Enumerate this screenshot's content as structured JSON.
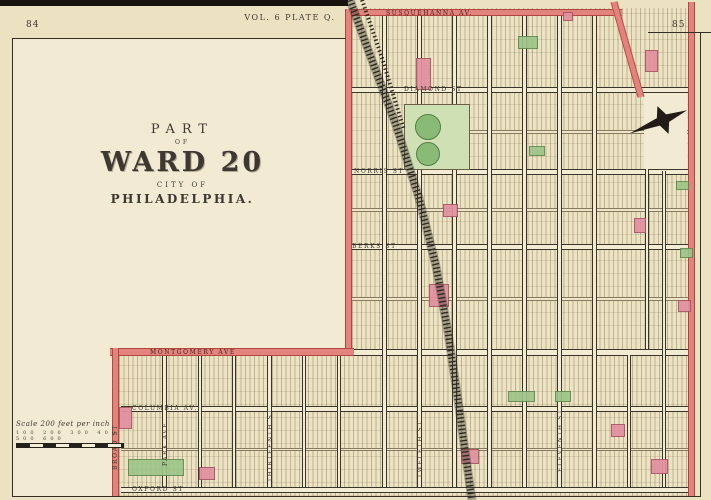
{
  "page": {
    "left_number": "84",
    "right_number": "85",
    "plate_title": "VOL. 6 PLATE Q."
  },
  "title_block": {
    "line1": "PART",
    "line2": "OF",
    "line3": "WARD 20",
    "line4": "CITY OF",
    "line5": "PHILADELPHIA."
  },
  "scale_bar": {
    "caption": "Scale 200 feet per inch",
    "ticks": "100 200 300 400 500 600"
  },
  "colors": {
    "paper": "#ebe2c2",
    "pink_street": "#e2837d",
    "pink_block": "#e190a0",
    "green_block": "#9cc488",
    "ink": "#3a352b"
  },
  "map": {
    "hatch_areas": [
      {
        "x": 352,
        "y": 8,
        "w": 337,
        "h": 344
      },
      {
        "x": 119,
        "y": 355,
        "w": 570,
        "h": 141
      }
    ],
    "blank_panels": [
      {
        "x": 13,
        "y": 39,
        "w": 332,
        "h": 312
      },
      {
        "x": 13,
        "y": 351,
        "w": 99,
        "h": 145
      }
    ],
    "blank_overlays": [
      {
        "x": 644,
        "y": 93,
        "w": 43,
        "h": 76
      }
    ],
    "streets_horizontal": [
      {
        "y": 87,
        "h": 6,
        "x1": 350,
        "x2": 689,
        "type": "main",
        "name": "DIAMOND ST",
        "label_x": 404
      },
      {
        "y": 130,
        "h": 4,
        "x1": 468,
        "x2": 689,
        "type": "minor"
      },
      {
        "y": 169,
        "h": 6,
        "x1": 350,
        "x2": 689,
        "type": "main",
        "name": "NORRIS ST",
        "label_x": 354
      },
      {
        "y": 208,
        "h": 4,
        "x1": 350,
        "x2": 689,
        "type": "minor"
      },
      {
        "y": 244,
        "h": 6,
        "x1": 350,
        "x2": 689,
        "type": "main",
        "name": "BERKS ST",
        "label_x": 352
      },
      {
        "y": 297,
        "h": 4,
        "x1": 350,
        "x2": 689,
        "type": "minor"
      },
      {
        "y": 349,
        "h": 7,
        "x1": 352,
        "x2": 689,
        "type": "main"
      },
      {
        "y": 406,
        "h": 6,
        "x1": 121,
        "x2": 689,
        "type": "main",
        "name": "COLUMBIA AV.",
        "label_x": 132
      },
      {
        "y": 448,
        "h": 3,
        "x1": 121,
        "x2": 689,
        "type": "minor"
      },
      {
        "y": 487,
        "h": 6,
        "x1": 121,
        "x2": 689,
        "type": "main",
        "name": "OXFORD ST",
        "label_x": 132
      }
    ],
    "streets_vertical": [
      {
        "x": 382,
        "w": 5,
        "y1": 16,
        "y2": 487
      },
      {
        "x": 417,
        "w": 5,
        "y1": 16,
        "y2": 487,
        "name": "TWELFTH ST",
        "label_y": 478
      },
      {
        "x": 452,
        "w": 5,
        "y1": 16,
        "y2": 487
      },
      {
        "x": 487,
        "w": 5,
        "y1": 16,
        "y2": 487
      },
      {
        "x": 522,
        "w": 5,
        "y1": 16,
        "y2": 487
      },
      {
        "x": 557,
        "w": 5,
        "y1": 16,
        "y2": 487,
        "name": "ELEVENTH ST",
        "label_y": 472
      },
      {
        "x": 592,
        "w": 5,
        "y1": 16,
        "y2": 487
      },
      {
        "x": 627,
        "w": 4,
        "y1": 355,
        "y2": 487
      },
      {
        "x": 645,
        "w": 4,
        "y1": 97,
        "y2": 349
      },
      {
        "x": 662,
        "w": 4,
        "y1": 171,
        "y2": 487
      },
      {
        "x": 162,
        "w": 5,
        "y1": 355,
        "y2": 487,
        "name": "PARK AVE",
        "label_y": 466
      },
      {
        "x": 198,
        "w": 4,
        "y1": 355,
        "y2": 487
      },
      {
        "x": 232,
        "w": 4,
        "y1": 355,
        "y2": 487
      },
      {
        "x": 267,
        "w": 5,
        "y1": 355,
        "y2": 487,
        "name": "THIRTEENTH ST",
        "label_y": 482
      },
      {
        "x": 302,
        "w": 4,
        "y1": 355,
        "y2": 487
      },
      {
        "x": 337,
        "w": 4,
        "y1": 355,
        "y2": 487
      }
    ],
    "pink_streets": [
      {
        "kind": "h",
        "x": 345,
        "y": 9,
        "w": 277,
        "h": 7,
        "name": "SUSQUEHANNA AV.",
        "label_x": 386,
        "label_y": 10
      },
      {
        "kind": "v",
        "x": 345,
        "y": 9,
        "w": 7,
        "h": 347
      },
      {
        "kind": "h",
        "x": 110,
        "y": 348,
        "w": 244,
        "h": 8,
        "name": "MONTGOMERY AVE",
        "label_x": 150,
        "label_y": 349
      },
      {
        "kind": "v",
        "x": 112,
        "y": 348,
        "w": 7,
        "h": 149,
        "name": "BROAD ST",
        "vlabel_x": 112,
        "vlabel_y": 470
      },
      {
        "kind": "v",
        "x": 688,
        "y": 2,
        "w": 7,
        "h": 495
      }
    ],
    "green_pale_rects": [
      {
        "x": 404,
        "y": 104,
        "w": 66,
        "h": 66
      }
    ],
    "green_circles": [
      {
        "cx": 428,
        "cy": 127,
        "r": 13
      },
      {
        "cx": 428,
        "cy": 154,
        "r": 12
      }
    ],
    "green_rects": [
      {
        "x": 518,
        "y": 36,
        "w": 20,
        "h": 13
      },
      {
        "x": 529,
        "y": 146,
        "w": 16,
        "h": 10
      },
      {
        "x": 676,
        "y": 181,
        "w": 13,
        "h": 9
      },
      {
        "x": 680,
        "y": 248,
        "w": 13,
        "h": 10
      },
      {
        "x": 508,
        "y": 391,
        "w": 27,
        "h": 11
      },
      {
        "x": 555,
        "y": 391,
        "w": 16,
        "h": 11
      },
      {
        "x": 128,
        "y": 459,
        "w": 56,
        "h": 17
      }
    ],
    "pink_rects": [
      {
        "x": 416,
        "y": 58,
        "w": 15,
        "h": 32
      },
      {
        "x": 645,
        "y": 50,
        "w": 13,
        "h": 22
      },
      {
        "x": 563,
        "y": 12,
        "w": 10,
        "h": 9
      },
      {
        "x": 443,
        "y": 204,
        "w": 15,
        "h": 13
      },
      {
        "x": 429,
        "y": 284,
        "w": 20,
        "h": 23
      },
      {
        "x": 634,
        "y": 218,
        "w": 12,
        "h": 15
      },
      {
        "x": 678,
        "y": 300,
        "w": 13,
        "h": 12
      },
      {
        "x": 119,
        "y": 407,
        "w": 13,
        "h": 22
      },
      {
        "x": 199,
        "y": 467,
        "w": 16,
        "h": 13
      },
      {
        "x": 461,
        "y": 449,
        "w": 18,
        "h": 15
      },
      {
        "x": 611,
        "y": 424,
        "w": 14,
        "h": 13
      },
      {
        "x": 651,
        "y": 459,
        "w": 17,
        "h": 15
      }
    ],
    "railroad": {
      "main": "350,0 370,55 396,125 419,198 436,266 448,332 458,400 466,458 472,500",
      "spur": "362,0 382,58 404,130"
    },
    "pink_diagonal": {
      "x1": 614,
      "y1": 2,
      "x2": 641,
      "y2": 97
    },
    "compass": {
      "cx": 663,
      "cy": 120,
      "rot": -22
    },
    "borders": [
      {
        "x": 12,
        "y": 38,
        "w": 334,
        "h": 1
      },
      {
        "x": 12,
        "y": 38,
        "w": 1,
        "h": 459
      },
      {
        "x": 12,
        "y": 496,
        "w": 689,
        "h": 1
      },
      {
        "x": 700,
        "y": 32,
        "w": 1,
        "h": 465
      },
      {
        "x": 648,
        "y": 32,
        "w": 63,
        "h": 1
      }
    ],
    "top_strip": {
      "x": 0,
      "y": 0,
      "w": 348,
      "h": 6
    }
  }
}
